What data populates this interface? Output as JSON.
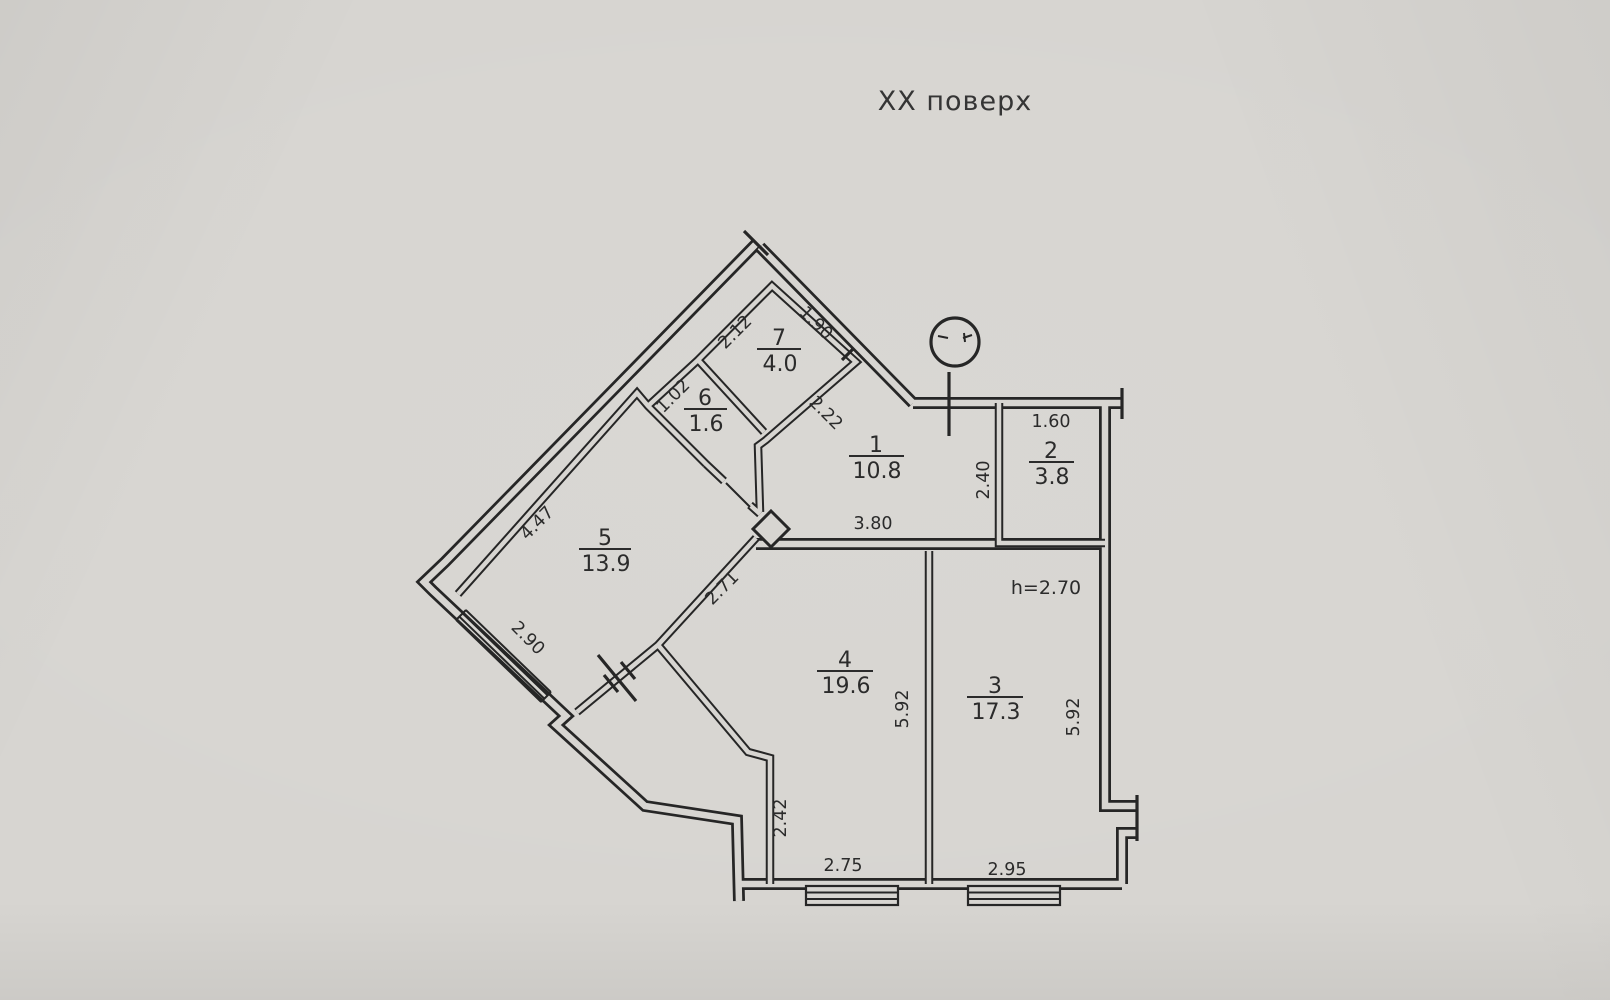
{
  "title": "XX поверх",
  "floor_plan": {
    "ceiling_height_label": "h=2.70",
    "rooms": [
      {
        "number": "1",
        "area": "10.8"
      },
      {
        "number": "2",
        "area": "3.8"
      },
      {
        "number": "3",
        "area": "17.3"
      },
      {
        "number": "4",
        "area": "19.6"
      },
      {
        "number": "5",
        "area": "13.9"
      },
      {
        "number": "6",
        "area": "1.6"
      },
      {
        "number": "7",
        "area": "4.0"
      }
    ],
    "dimensions": {
      "d212": "2.12",
      "d190": "1.90",
      "d102": "1.02",
      "d222": "2.22",
      "d160": "1.60",
      "d240": "2.40",
      "d447": "4.47",
      "d290": "2.90",
      "d380": "3.80",
      "d271": "2.71",
      "d592_left": "5.92",
      "d592_right": "5.92",
      "d242": "2.42",
      "d275": "2.75",
      "d295": "2.95"
    }
  }
}
